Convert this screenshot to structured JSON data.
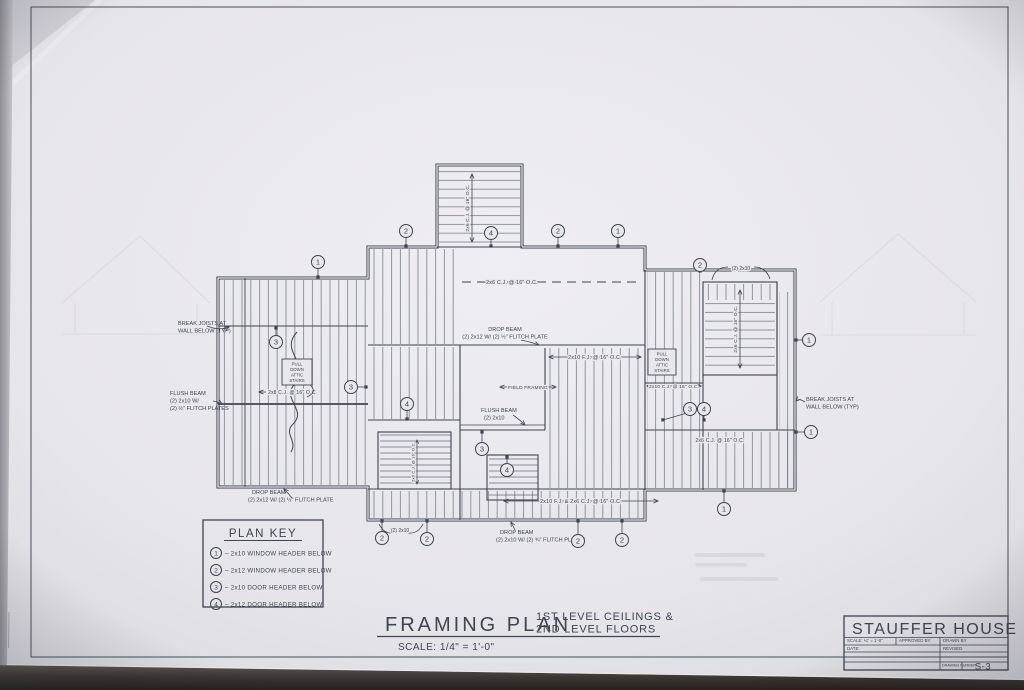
{
  "sheet": {
    "title_block": {
      "project": "STAUFFER HOUSE",
      "scale_label": "SCALE: ¼\" = 1'-0\"",
      "approved_by_label": "APPROVED BY:",
      "date_label": "DATE:",
      "drawn_by_label": "DRAWN BY",
      "revised_label": "REVISED",
      "drawing_number_label": "DRAWING NUMBER",
      "drawing_number": "S-3"
    },
    "drawing_title": {
      "title": "FRAMING PLAN",
      "subtitle_line1": "1ST LEVEL CEILINGS &",
      "subtitle_line2": "2ND LEVEL FLOORS",
      "scale": "SCALE: 1/4\" = 1'-0\""
    },
    "plan_key": {
      "title": "PLAN KEY",
      "items": [
        {
          "symbol": "1",
          "label": "2x10 WINDOW HEADER BELOW"
        },
        {
          "symbol": "2",
          "label": "2x12 WINDOW HEADER BELOW"
        },
        {
          "symbol": "3",
          "label": "2x10 DOOR HEADER BELOW"
        },
        {
          "symbol": "4",
          "label": "2x12 DOOR HEADER BELOW"
        }
      ]
    },
    "plan": {
      "dims": {
        "cj26": "2x6 C.J. @ 16\" O.C.",
        "fj210": "2x10 F.J. @ 16\" O.C.",
        "cj210": "2x10 C.J. @ 16\" O.C.",
        "cj28": "2x8 C.J. @ 16\" O.C.",
        "combo": "2x10 F.J. & 2x6 C.J. @ 16\" O.C."
      },
      "notes": {
        "break_joists_1": "BREAK JOISTS AT",
        "break_joists_2": "WALL BELOW (TYP)",
        "flush_beam_l1": "FLUSH BEAM",
        "flush_beam_l2": "(2) 2x10 W/",
        "flush_beam_l3": "(2) ½\" FLITCH PLATES",
        "drop_beam_sw1": "DROP BEAM",
        "drop_beam_sw2": "(2) 2x12 W/ (2) ½\" FLITCH PLATE",
        "drop_beam_n1": "DROP BEAM",
        "drop_beam_n2": "(2) 2x12 W/ (2) ½\" FLITCH PLATE",
        "drop_beam_s1": "DROP BEAM",
        "drop_beam_s2": "(2) 2x10 W/ (2) ¾\" FLITCH PLATES",
        "flush_beam_c1": "FLUSH BEAM",
        "flush_beam_c2": "(2) 2x10",
        "field_framing": "FIELD FRAMING",
        "pull_down": [
          "PULL",
          "DOWN",
          "ATTIC",
          "STAIRS"
        ],
        "two_2x10": "(2) 2x10"
      },
      "balloons": [
        {
          "n": "1",
          "x": 318,
          "y": 262,
          "tx": 318,
          "ty": 277
        },
        {
          "n": "2",
          "x": 406,
          "y": 231,
          "tx": 406,
          "ty": 246
        },
        {
          "n": "4",
          "x": 491,
          "y": 233,
          "tx": 491,
          "ty": 246
        },
        {
          "n": "2",
          "x": 558,
          "y": 231,
          "tx": 558,
          "ty": 246
        },
        {
          "n": "1",
          "x": 618,
          "y": 231,
          "tx": 618,
          "ty": 246
        },
        {
          "n": "2",
          "x": 700,
          "y": 265,
          "tx": 700,
          "ty": 271
        },
        {
          "n": "1",
          "x": 809,
          "y": 340,
          "tx": 796,
          "ty": 340
        },
        {
          "n": "3",
          "x": 276,
          "y": 342,
          "tx": 276,
          "ty": 328
        },
        {
          "n": "3",
          "x": 351,
          "y": 387,
          "tx": 366,
          "ty": 387
        },
        {
          "n": "4",
          "x": 407,
          "y": 404,
          "tx": 407,
          "ty": 419
        },
        {
          "n": "3",
          "x": 482,
          "y": 449,
          "tx": 482,
          "ty": 432
        },
        {
          "n": "4",
          "x": 507,
          "y": 470,
          "tx": 507,
          "ty": 457
        },
        {
          "n": "3",
          "x": 690,
          "y": 409
        },
        {
          "n": "4",
          "x": 704,
          "y": 409,
          "tx": 704,
          "ty": 420
        },
        {
          "n": "1",
          "x": 811,
          "y": 432,
          "tx": 796,
          "ty": 432
        },
        {
          "n": "2",
          "x": 382,
          "y": 538,
          "tx": 382,
          "ty": 521
        },
        {
          "n": "2",
          "x": 427,
          "y": 539,
          "tx": 427,
          "ty": 521
        },
        {
          "n": "2",
          "x": 578,
          "y": 541,
          "tx": 578,
          "ty": 521
        },
        {
          "n": "2",
          "x": 622,
          "y": 540,
          "tx": 622,
          "ty": 521
        },
        {
          "n": "1",
          "x": 724,
          "y": 509,
          "tx": 724,
          "ty": 491
        }
      ]
    },
    "colors": {
      "paper": "#e8e7eb",
      "ink": "#3f4450",
      "hatch": "#6b7180",
      "desk": "#2b2825"
    }
  }
}
